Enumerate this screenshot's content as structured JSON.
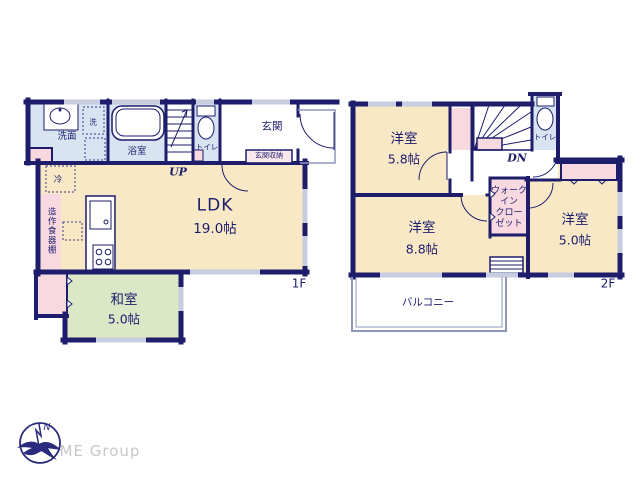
{
  "palette": {
    "wall": "#1d1d6b",
    "room_cream": "#f9e8c5",
    "room_green": "#dbe7c5",
    "room_blue": "#d8e4f1",
    "room_pink": "#f8d9e0",
    "room_pink_light": "#fbe8ec",
    "window": "#c7cde1",
    "text": "#1c1c6e",
    "logo_blue": "#2b2b7e",
    "logo_gray": "#c8c8c8"
  },
  "floor1": {
    "floor_label": "1F",
    "ldk": {
      "name": "LDK",
      "size": "19.0帖"
    },
    "washitsu": {
      "name": "和室",
      "size": "5.0帖"
    },
    "washroom": "洗面",
    "laundry": "洗",
    "bathroom": "浴室",
    "toilet": "トイレ",
    "entrance": "玄関",
    "entrance_storage": "玄関収納",
    "refrigerator": "冷",
    "cupboard": "造作食器棚",
    "stairs": "UP"
  },
  "floor2": {
    "floor_label": "2F",
    "bedroom_a": {
      "name": "洋室",
      "size": "5.8帖"
    },
    "bedroom_b": {
      "name": "洋室",
      "size": "8.8帖"
    },
    "bedroom_c": {
      "name": "洋室",
      "size": "5.0帖"
    },
    "walk_in_closet": {
      "lines": [
        "ウォーク",
        "イン",
        "クロー",
        "ゼット"
      ]
    },
    "toilet": "トイレ",
    "balcony": "バルコニー",
    "stairs": "DN"
  },
  "logo": {
    "company": "ME Group",
    "compass_letter": "N"
  }
}
